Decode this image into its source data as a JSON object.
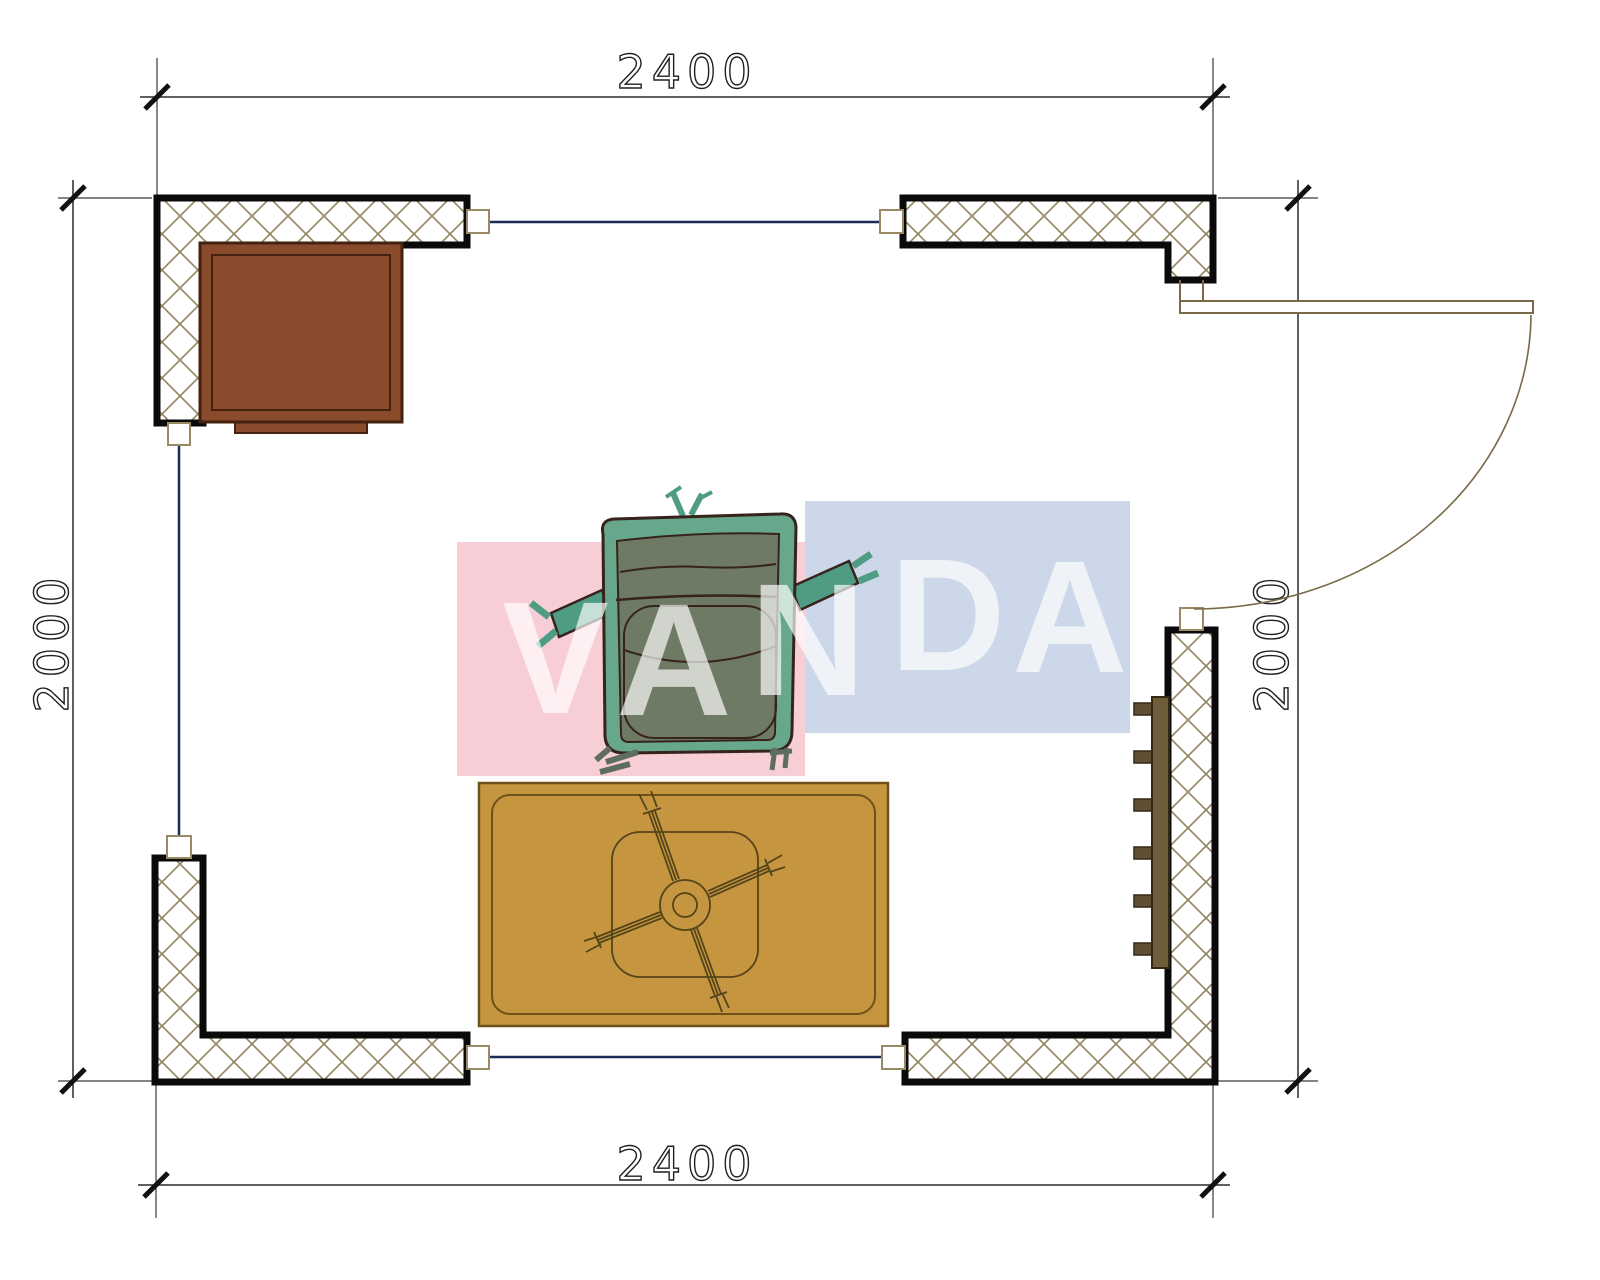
{
  "title": "Room floor plan 2400 x 2000 with furniture",
  "dimensions": {
    "top": "2400",
    "bottom": "2400",
    "left": "2000",
    "right": "2000"
  },
  "watermark": {
    "text": "VANDA",
    "letters": [
      "V",
      "A",
      "N",
      "D",
      "A"
    ]
  },
  "colors": {
    "pinkBlock": "#f7cdd6",
    "blueBlock": "#ccd8e9",
    "hatch": "#93835f",
    "wallOutline": "#0a0a0a",
    "connector": "#9a8a64",
    "navyWindowLine": "#1c2b55",
    "dimLine": "#2a2a2a",
    "cabinet": "#8a4a2c",
    "cabinetEdge": "#44220f",
    "rug": "#c6953f",
    "rugEdge": "#6e511c",
    "pedestalLine": "#54441a",
    "chairShell": "#67a78b",
    "chairPanel": "#6f7a64",
    "chairAccent": "#4f9c84",
    "chairOutline": "#36231c",
    "radiator": "#6f5c39",
    "radiatorEdge": "#332811",
    "doorLine": "#7a6a48",
    "watermarkText": "#ffffff"
  },
  "furniture": {
    "cabinet": "cabinet-top-left",
    "armchair": "armchair-center",
    "table": "low-table-on-rug",
    "radiator": "radiator-right-wall",
    "door": "door-right-swing"
  }
}
